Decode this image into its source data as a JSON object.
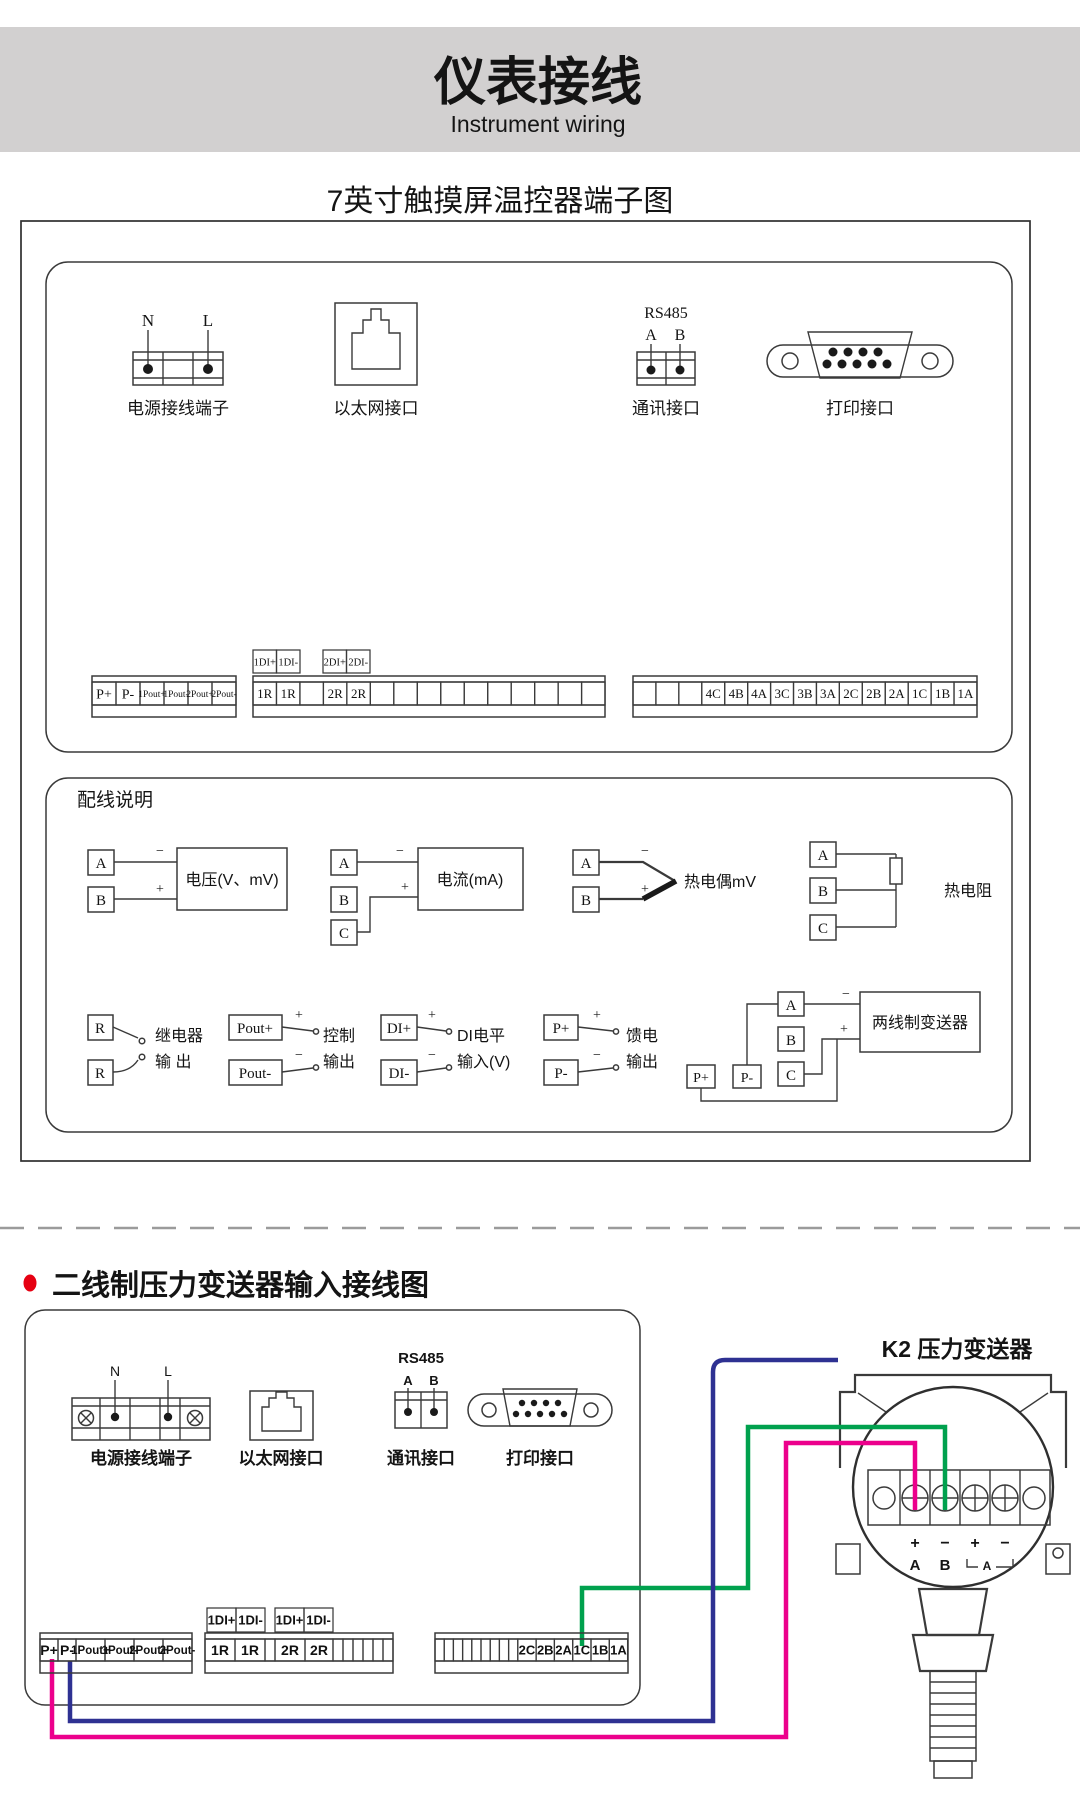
{
  "colors": {
    "header_gray": "#D2D0D0",
    "accent_red": "#E60012",
    "green": "#00A14E",
    "pink": "#EC008C",
    "blue": "#2E3192"
  },
  "header": {
    "title_cn": "仪表接线",
    "title_en": "Instrument wiring"
  },
  "section1": {
    "title": "7英寸触摸屏温控器端子图",
    "ports": {
      "n": "N",
      "l": "L",
      "power_caption": "电源接线端子",
      "ethernet_caption": "以太网接口",
      "rs485": "RS485",
      "rs485_a": "A",
      "rs485_b": "B",
      "comm_caption": "通讯接口",
      "printer_caption": "打印接口"
    },
    "strips": {
      "left": [
        "P+",
        "P-",
        "1Pout+",
        "1Pout-",
        "2Pout+",
        "2Pout-"
      ],
      "di1": [
        "1DI+",
        "1DI-"
      ],
      "di2": [
        "2DI+",
        "2DI-"
      ],
      "middle": [
        "1R",
        "1R",
        "",
        "2R",
        "2R",
        "",
        "",
        "",
        "",
        "",
        "",
        "",
        "",
        "",
        ""
      ],
      "right": [
        "",
        "",
        "",
        "4C",
        "4B",
        "4A",
        "3C",
        "3B",
        "3A",
        "2C",
        "2B",
        "2A",
        "1C",
        "1B",
        "1A"
      ]
    },
    "wiring": {
      "title": "配线说明",
      "voltage": {
        "a": "A",
        "b": "B",
        "minus": "−",
        "plus": "+",
        "label": "电压(V、mV)"
      },
      "current": {
        "a": "A",
        "b": "B",
        "c": "C",
        "minus": "−",
        "plus": "+",
        "label": "电流(mA)"
      },
      "thermocouple": {
        "a": "A",
        "b": "B",
        "minus": "−",
        "plus": "+",
        "label": "热电偶mV"
      },
      "rtd": {
        "a": "A",
        "b": "B",
        "c": "C",
        "label": "热电阻"
      },
      "relay": {
        "r1": "R",
        "r2": "R",
        "label1": "继电器",
        "label2": "输 出"
      },
      "control": {
        "p1": "Pout+",
        "p2": "Pout-",
        "plus": "+",
        "minus": "−",
        "label1": "控制",
        "label2": "输出"
      },
      "di": {
        "p1": "DI+",
        "p2": "DI-",
        "plus": "+",
        "minus": "−",
        "label1": "DI电平",
        "label2": "输入(V)"
      },
      "feed": {
        "p1": "P+",
        "p2": "P-",
        "plus": "+",
        "minus": "−",
        "label1": "馈电",
        "label2": "输出"
      },
      "twowire": {
        "a": "A",
        "b": "B",
        "c": "C",
        "pplus": "P+",
        "pminus": "P-",
        "minus": "−",
        "plus": "+",
        "label": "两线制变送器"
      }
    }
  },
  "section2": {
    "title": "二线制压力变送器输入接线图",
    "transmitter_title": "K2 压力变送器",
    "ports": {
      "n": "N",
      "l": "L",
      "power_caption": "电源接线端子",
      "ethernet_caption": "以太网接口",
      "rs485": "RS485",
      "rs485_a": "A",
      "rs485_b": "B",
      "comm_caption": "通讯接口",
      "printer_caption": "打印接口"
    },
    "strips": {
      "left": [
        "P+",
        "P-",
        "1Pout+",
        "1Pout-",
        "2Pout+",
        "2Pout-"
      ],
      "di1": [
        "1DI+",
        "1DI-"
      ],
      "di2": [
        "1DI+",
        "1DI-"
      ],
      "middle": [
        "1R",
        "1R",
        "",
        "2R",
        "2R",
        "",
        "",
        "",
        "",
        "",
        ""
      ],
      "right": [
        "",
        "",
        "",
        "",
        "",
        "",
        "",
        "",
        "",
        "2C",
        "2B",
        "2A",
        "1C",
        "1B",
        "1A"
      ]
    },
    "transmitter": {
      "t1_plus": "+",
      "t1_minus": "−",
      "t2_plus": "+",
      "t2_minus": "−",
      "a": "A",
      "b": "B",
      "pair2": "A"
    }
  }
}
